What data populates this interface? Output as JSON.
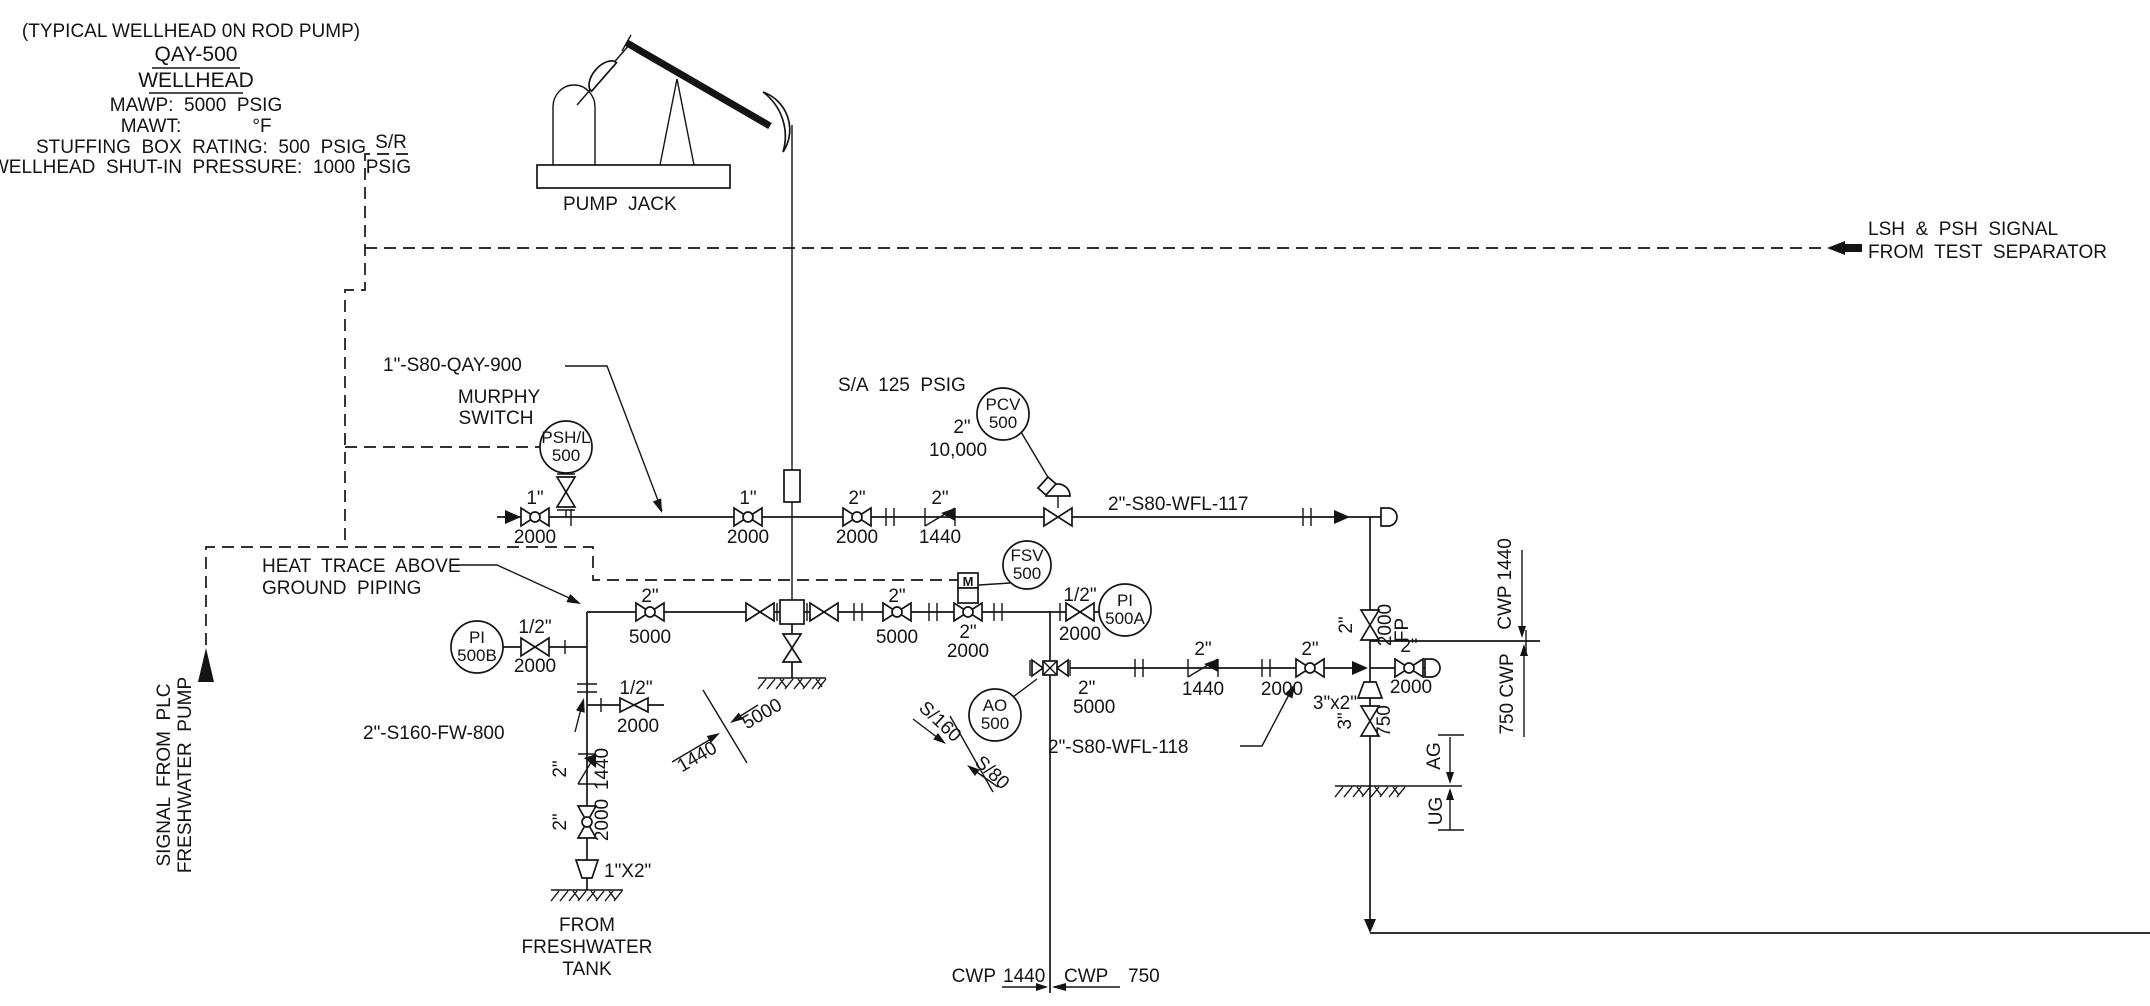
{
  "tb": {
    "note": "(TYPICAL WELLHEAD 0N ROD PUMP)",
    "tag": "QAY-500",
    "sub": "WELLHEAD",
    "mawp": "MAWP:  5000  PSIG",
    "mawt_l": "MAWT:",
    "mawt_v": "°F",
    "stuffing": "STUFFING  BOX  RATING:  500  PSIG",
    "shutin": "WELLHEAD  SHUT-IN  PRESSURE:  1000  PSIG"
  },
  "pj": {
    "sr": "S/R",
    "label": "PUMP  JACK"
  },
  "sig": {
    "lsh1": "LSH  &  PSH  SIGNAL",
    "lsh2": "FROM  TEST  SEPARATOR",
    "plc1": "SIGNAL  FROM  PLC",
    "plc2": "FRESHWATER  PUMP"
  },
  "inst": {
    "psh1": "PSH/L",
    "psh2": "500",
    "pcv1": "PCV",
    "pcv2": "500",
    "fsv1": "FSV",
    "fsv2": "500",
    "pia1": "PI",
    "pia2": "500A",
    "pib1": "PI",
    "pib2": "500B",
    "ao1": "AO",
    "ao2": "500",
    "m": "M"
  },
  "ln": {
    "qay900": "1\"-S80-QAY-900",
    "wfl117": "2\"-S80-WFL-117",
    "wfl118": "2\"-S80-WFL-118",
    "fw800": "2\"-S160-FW-800",
    "sa": "S/A  125  PSIG"
  },
  "nt": {
    "murphy1": "MURPHY",
    "murphy2": "SWITCH",
    "ht1": "HEAT  TRACE  ABOVE",
    "ht2": "GROUND  PIPING",
    "fwt1": "FROM",
    "fwt2": "FRESHWATER",
    "fwt3": "TANK"
  },
  "v": [
    {
      "s": "1\"",
      "r": "2000"
    },
    {
      "s": "1\"",
      "r": "2000"
    },
    {
      "s": "2\"",
      "r": "2000"
    },
    {
      "s": "2\"",
      "r": "1440"
    },
    {
      "s": "2\"",
      "r": "10,000"
    },
    {
      "s": "2\"",
      "r": "5000"
    },
    {
      "s": "2\"",
      "r": "5000"
    },
    {
      "s": "2\"",
      "r": "2000"
    },
    {
      "s": "1/2\"",
      "r": "2000"
    },
    {
      "s": "1/2\"",
      "r": "2000"
    },
    {
      "s": "1/2\"",
      "r": "2000"
    },
    {
      "s": "2\"",
      "r": "1440"
    },
    {
      "s": "2\"",
      "r": "2000"
    },
    {
      "s": "2\"",
      "r": "5000"
    },
    {
      "s": "2\"",
      "r": "1440"
    },
    {
      "s": "2\"",
      "r": "2000"
    },
    {
      "s": "2\"",
      "r": "2000",
      "fp": "FP"
    },
    {
      "s": "2\"",
      "r": "2000"
    },
    {
      "s": "3\"",
      "r": "750"
    }
  ],
  "red": {
    "a": "1\"X2\"",
    "b": "3\"x2\""
  },
  "brk": {
    "a1": "1440",
    "a2": "5000",
    "b1": "S/160",
    "b2": "S/80",
    "cwp_above": "CWP 1440",
    "cwp_below": "750 CWP",
    "bl": "CWP",
    "bl2": "1440",
    "br": "CWP",
    "br2": "750",
    "ag": "AG",
    "ug": "UG"
  }
}
